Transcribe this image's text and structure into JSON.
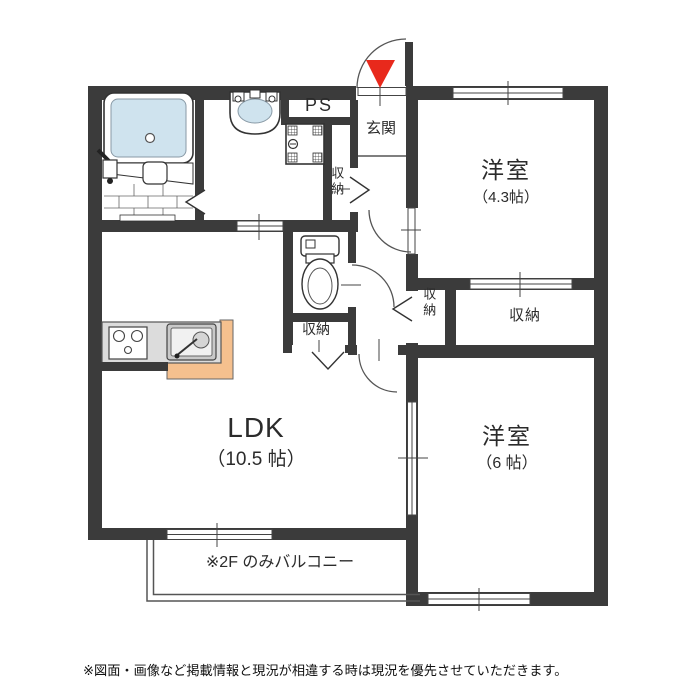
{
  "plan": {
    "rooms": {
      "ps": {
        "label": "PS"
      },
      "genkan": {
        "label": "玄関"
      },
      "bedroom1": {
        "label": "洋室",
        "size": "（4.3帖）"
      },
      "bedroom2": {
        "label": "洋室",
        "size": "（6 帖）"
      },
      "ldk": {
        "label": "LDK",
        "size": "（10.5 帖）"
      },
      "closet_washroom": {
        "label": "収納"
      },
      "closet_toilet": {
        "label": "収納"
      },
      "closet_hall": {
        "label": "収納"
      },
      "closet_bedroom1": {
        "label": "収納"
      }
    },
    "balcony_note": "※2F のみバルコニー",
    "disclaimer": "※図面・画像など掲載情報と現況が相違する時は現況を優先させていただきます。",
    "colors": {
      "wall": "#3b3b3b",
      "water_blue": "#cfe3ee",
      "marker_red": "#e8291c",
      "counter_gray": "#dcdcdc",
      "counter_peach": "#f5c08e"
    }
  }
}
